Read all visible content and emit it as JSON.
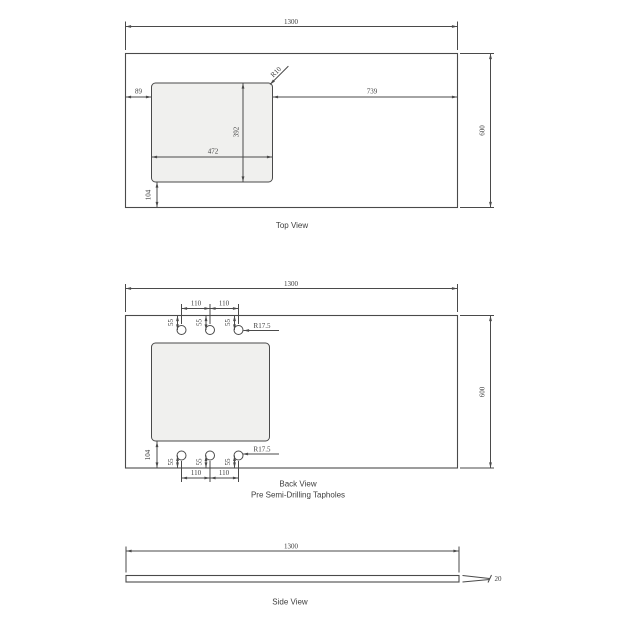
{
  "colors": {
    "line": "#4a4a4a",
    "ink": "#3e3e3e",
    "cutout_fill": "#f0f0ee",
    "background": "#ffffff"
  },
  "top_view": {
    "title": "Top View",
    "dim_width": "1300",
    "dim_depth": "600",
    "dim_offset_left": "89",
    "dim_offset_right": "739",
    "dim_cutout_width": "472",
    "dim_cutout_depth": "392",
    "dim_offset_bottom": "104",
    "corner_radius": "R10"
  },
  "back_view": {
    "title": "Back View",
    "subtitle": "Pre Semi-Drilling Tapholes",
    "dim_width": "1300",
    "dim_depth": "600",
    "dim_offset_bottom": "104",
    "top_row": {
      "spacings": [
        "110",
        "110"
      ],
      "edge_offsets": [
        "55",
        "55",
        "55"
      ],
      "radius_label": "R17.5"
    },
    "bottom_row": {
      "spacings": [
        "110",
        "110"
      ],
      "edge_offsets": [
        "55",
        "55",
        "55"
      ],
      "radius_label": "R17.5"
    }
  },
  "side_view": {
    "title": "Side View",
    "dim_width": "1300",
    "dim_thickness": "20"
  }
}
